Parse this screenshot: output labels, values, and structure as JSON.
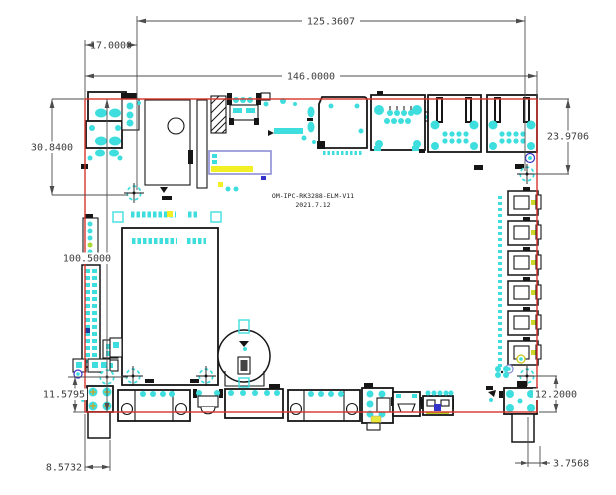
{
  "drawing": {
    "board_label": "OM-IPC-RK3288-ELM-V11",
    "board_date": "2021.7.12"
  },
  "dimensions": {
    "top_hole_span": "125.3607",
    "edge_to_first_hole": "17.0000",
    "board_width": "146.0000",
    "left_top_height": "30.8400",
    "right_top_height": "23.9706",
    "board_height": "100.5000",
    "bottom_left_vertical": "11.5795",
    "bottom_right_vertical": "12.2000",
    "bottom_left_horizontal": "8.5732",
    "bottom_right_horizontal": "3.7568"
  },
  "colors": {
    "background": "#ffffff",
    "board_outline": "#d8342c",
    "component_line": "#161616",
    "pad_cyan": "#3fdede",
    "dimension_line": "#4d4d4d",
    "dimension_text": "#3c3c3c",
    "highlight_yellow": "#f2ef25",
    "highlight_purple": "#8e8ed6",
    "accent_blue": "#3434c8"
  }
}
